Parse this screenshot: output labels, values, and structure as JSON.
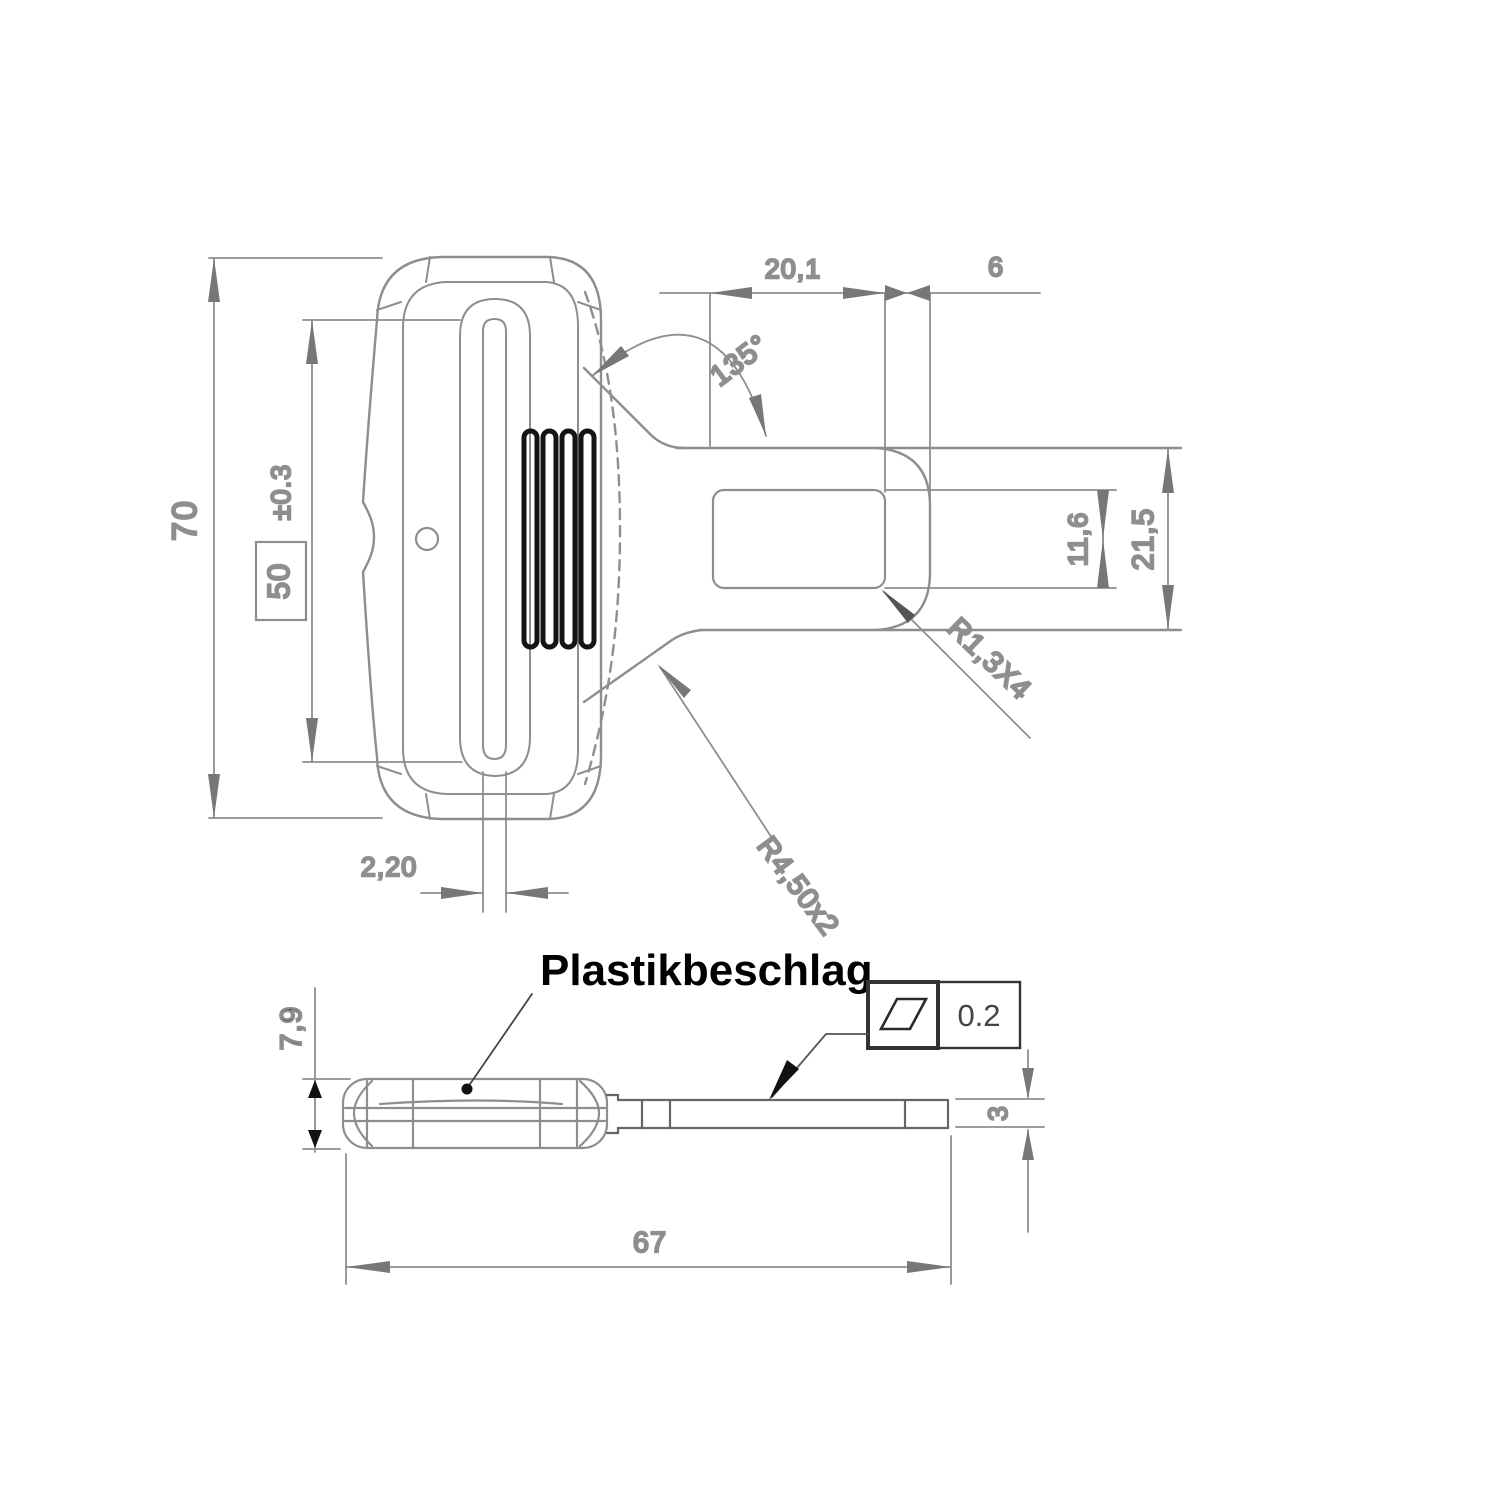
{
  "title": "Plastikbeschlag technical drawing",
  "part_label": "Plastikbeschlag",
  "colors": {
    "background": "#ffffff",
    "line_gray": "#8e8e8e",
    "line_dark": "#5a5a5a",
    "black": "#111111",
    "dim_text": "#8a8a8a",
    "dark_text": "#3a3a3a"
  },
  "top_view": {
    "dimensions": {
      "overall_height": "70",
      "slot_length": "50",
      "slot_length_tolerance": "±0.3",
      "slit_width": "2,20",
      "neck_angle": "135°",
      "plastic_cover_length": "20,1",
      "end_cap_length": "6",
      "slot_width": "11,6",
      "tongue_width": "21,5",
      "slot_corner_radius": "R1,3X4",
      "neck_fillet_radius": "R4,50x2"
    }
  },
  "side_view": {
    "dimensions": {
      "body_thickness": "7,9",
      "overall_length": "67",
      "tongue_thickness": "3",
      "flatness_tolerance": "0.2"
    }
  }
}
